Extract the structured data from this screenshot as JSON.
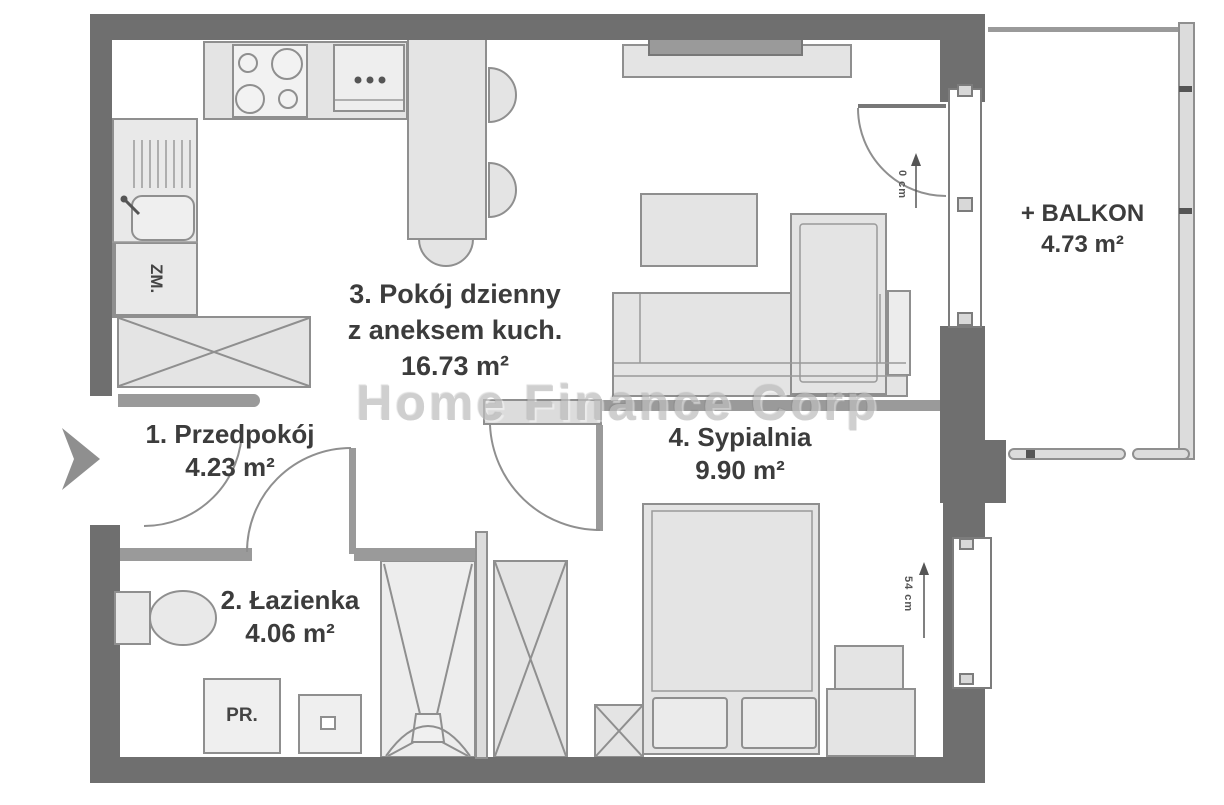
{
  "watermark": "Home Finance Corp",
  "rooms": {
    "hallway": {
      "name": "1. Przedpokój",
      "area": "4.23 m²"
    },
    "bathroom": {
      "name": "2. Łazienka",
      "area": "4.06 m²"
    },
    "living": {
      "name": "3. Pokój dzienny",
      "name2": "z aneksem kuch.",
      "area": "16.73 m²"
    },
    "bedroom": {
      "name": "4. Sypialnia",
      "area": "9.90 m²"
    },
    "balcony": {
      "name": "+ BALKON",
      "area": "4.73 m²"
    }
  },
  "labels": {
    "dishwasher": "ZM.",
    "washing_machine": "PR."
  },
  "dimensions": {
    "balcony_door_threshold": "0 cm",
    "bedroom_window_sill": "54 cm"
  },
  "colors": {
    "wall": "#6f6f6f",
    "furniture_fill": "#e4e4e4",
    "furniture_stroke": "#8f8f8f",
    "line": "#9a9a9a",
    "light_fill": "#dcdcdc",
    "text": "#3c3c3c",
    "detail_dark": "#555555",
    "watermark": "#bdbdbd"
  }
}
